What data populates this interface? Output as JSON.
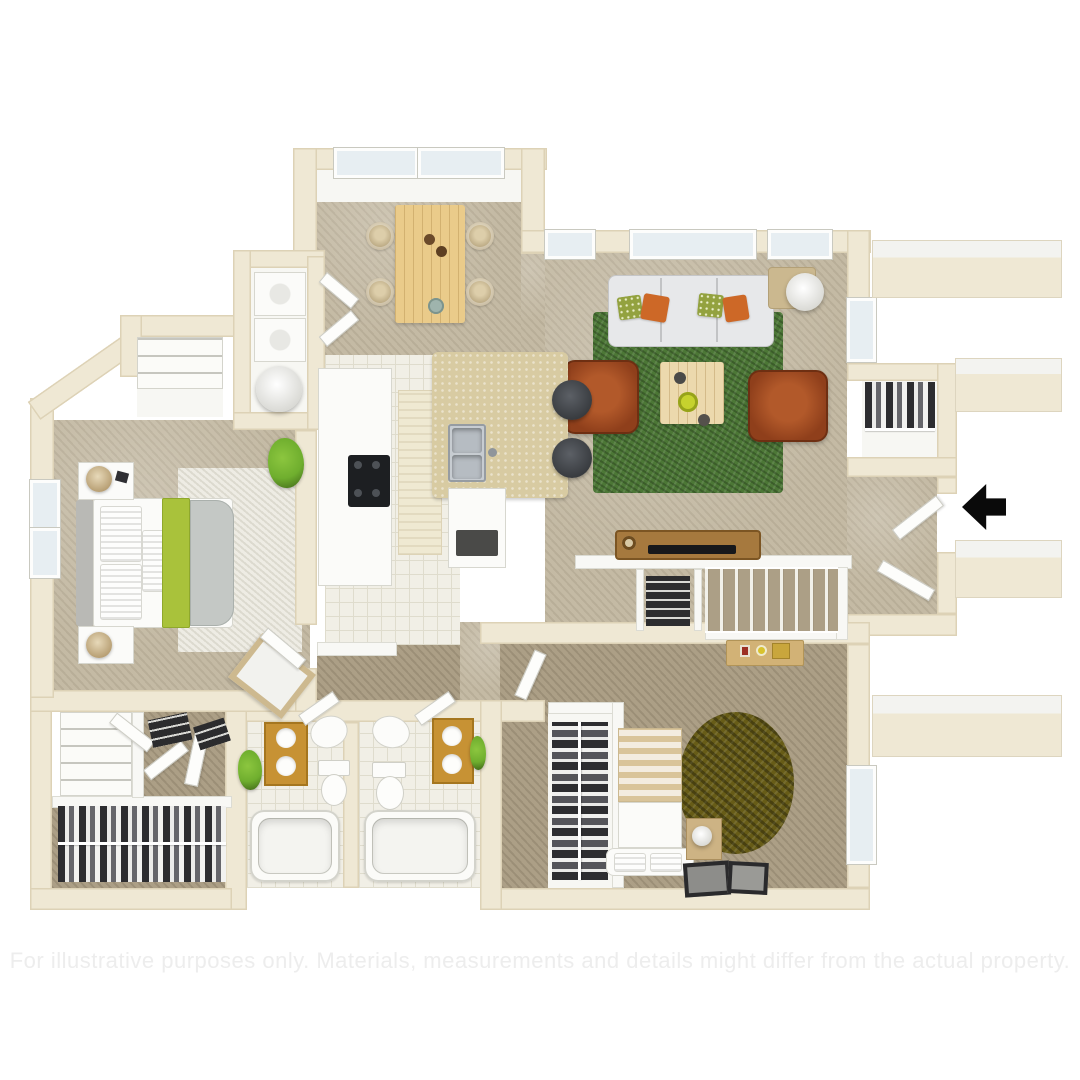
{
  "title": "3D apartment floor plan",
  "disclaimer": "For illustrative purposes only. Materials, measurements and details might differ from the actual property.",
  "entry": {
    "arrow_symbol": "left-pointing-arrow",
    "direction": "left"
  },
  "colors": {
    "wall": "#efe8d4",
    "wallEdge": "#ddd2b6",
    "carpet": "#c4baa4",
    "carpetShade": "#ac9f86",
    "tile": "#f1efe6",
    "tileLine": "#dfdccd",
    "rugGreen": "#4c7736",
    "rugRound": "#675c17",
    "rugWhite": "#eeece4",
    "woodTable": "#eacb8a",
    "woodConsole": "#a6793e",
    "deskTan": "#d2b276",
    "chairRust": "#8f3f1b",
    "sofaGray": "#e7e8ea",
    "pillowOrange": "#cd6827",
    "pillowGreen": "#93a23f",
    "vanityGold": "#c79234",
    "granite": "#d8cba2",
    "steel": "#c7ccd1",
    "stoolDark": "#383b3f",
    "lime": "#a9c23b",
    "plant": "#6fae2e",
    "clothesDark": "#2d2d30",
    "ledgeTop": "#f3f3f0",
    "windowGlass": "#e7eef2",
    "arrow": "#0a0a0a",
    "disclaimer": "#ededed",
    "interiorWall": "#f8f8f5",
    "applianceWhite": "#fbfbf9"
  },
  "rooms": [
    {
      "name": "dining-room",
      "furniture": [
        "dining-table",
        "four-wicker-chairs",
        "two-skylight-windows"
      ]
    },
    {
      "name": "living-room",
      "furniture": [
        "sofa",
        "two-rust-armchairs",
        "coffee-table",
        "green-area-rug",
        "floor-lamp",
        "side-table",
        "three-windows"
      ]
    },
    {
      "name": "kitchen",
      "furniture": [
        "range",
        "counter-run",
        "granite-island-bar",
        "double-sink",
        "two-bar-stools",
        "lower-cabinet"
      ]
    },
    {
      "name": "master-bedroom",
      "furniture": [
        "bed-with-lime-runner",
        "two-nightstands",
        "two-lamps",
        "white-rug",
        "plant",
        "tilted-mirror",
        "two-windows"
      ]
    },
    {
      "name": "second-bedroom",
      "furniture": [
        "striped-bed",
        "bench",
        "nightstand",
        "round-shag-rug",
        "hanging-closet",
        "desk",
        "two-picture-frames",
        "window"
      ]
    },
    {
      "name": "bathroom-1",
      "furniture": [
        "gold-double-vanity",
        "pedestal-sink",
        "toilet",
        "bathtub",
        "plant"
      ]
    },
    {
      "name": "bathroom-2",
      "furniture": [
        "pedestal-sink",
        "gold-vanity",
        "toilet",
        "bathtub",
        "plant"
      ]
    },
    {
      "name": "laundry-closet",
      "furniture": [
        "washer",
        "dryer",
        "water-heater",
        "bifold-doors"
      ]
    },
    {
      "name": "walk-in-closet",
      "furniture": [
        "hanging-clothes",
        "linen-shelves"
      ]
    },
    {
      "name": "coat-closet",
      "furniture": [
        "hanging-clothes"
      ]
    },
    {
      "name": "hallway",
      "furniture": [
        "media-console",
        "tv",
        "folded-linen-closet",
        "staircase",
        "half-wall"
      ]
    },
    {
      "name": "entry",
      "furniture": [
        "entry-arrow",
        "open-door",
        "patio-ledges"
      ]
    }
  ]
}
